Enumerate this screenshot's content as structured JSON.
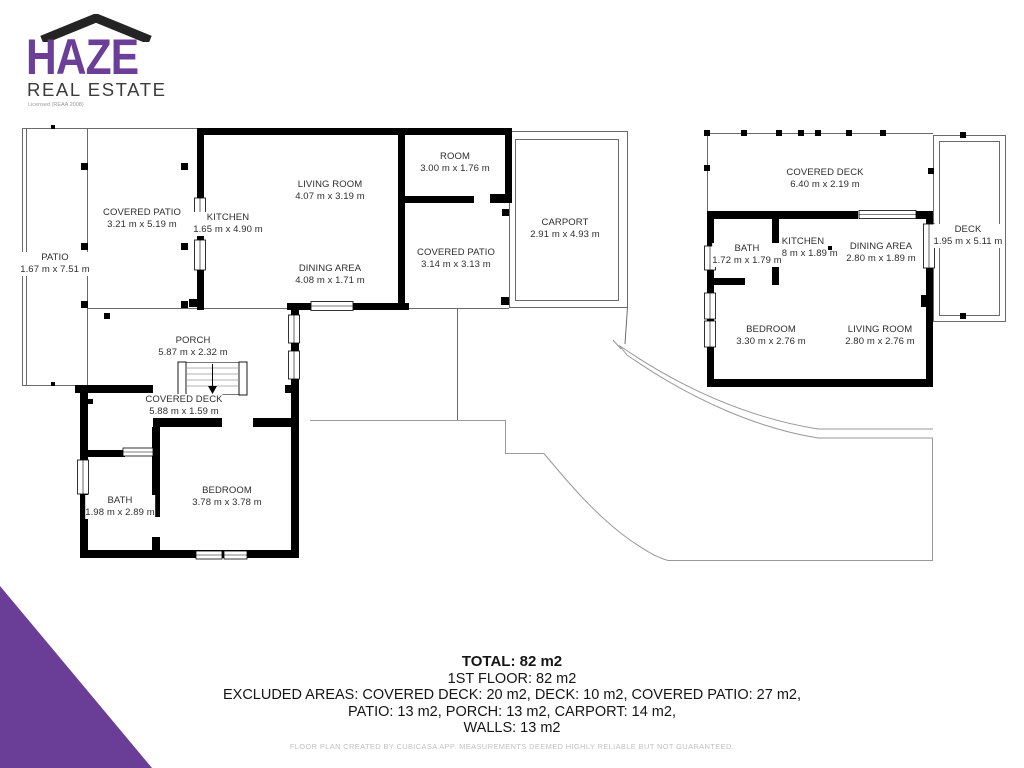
{
  "logo": {
    "name": "HAZE",
    "subtitle": "REAL ESTATE",
    "license": "Licensed (REAA 2008)",
    "brand_color": "#6b3e98",
    "roof_color": "#242424"
  },
  "plans": {
    "main": {
      "rooms": [
        {
          "name": "PATIO",
          "dims": "1.67 m x 7.51 m"
        },
        {
          "name": "COVERED PATIO",
          "dims": "3.21 m x 5.19 m"
        },
        {
          "name": "KITCHEN",
          "dims": "1.65 m x 4.90 m"
        },
        {
          "name": "LIVING ROOM",
          "dims": "4.07 m x 3.19 m"
        },
        {
          "name": "DINING AREA",
          "dims": "4.08 m x 1.71 m"
        },
        {
          "name": "ROOM",
          "dims": "3.00 m x 1.76 m"
        },
        {
          "name": "COVERED PATIO",
          "dims": "3.14 m x 3.13 m"
        },
        {
          "name": "CARPORT",
          "dims": "2.91 m x 4.93 m"
        },
        {
          "name": "PORCH",
          "dims": "5.87 m x 2.32 m"
        },
        {
          "name": "COVERED DECK",
          "dims": "5.88 m x 1.59 m"
        },
        {
          "name": "BATH",
          "dims": "1.98 m x 2.89 m"
        },
        {
          "name": "BEDROOM",
          "dims": "3.78 m x 3.78 m"
        }
      ]
    },
    "second": {
      "rooms": [
        {
          "name": "COVERED DECK",
          "dims": "6.40 m x 2.19 m"
        },
        {
          "name": "BATH",
          "dims": "1.72 m x 1.79 m"
        },
        {
          "name": "KITCHEN",
          "dims": "1.48 m x 1.89 m"
        },
        {
          "name": "DINING AREA",
          "dims": "2.80 m x 1.89 m"
        },
        {
          "name": "DECK",
          "dims": "1.95 m x 5.11 m"
        },
        {
          "name": "BEDROOM",
          "dims": "3.30 m x 2.76 m"
        },
        {
          "name": "LIVING ROOM",
          "dims": "2.80 m x 2.76 m"
        }
      ]
    }
  },
  "summary": {
    "total": "TOTAL: 82 m2",
    "first_floor": "1ST FLOOR: 82 m2",
    "excluded_line1": "EXCLUDED AREAS: COVERED DECK: 20 m2, DECK: 10 m2, COVERED PATIO: 27 m2,",
    "excluded_line2": "PATIO: 13 m2, PORCH: 13 m2, CARPORT: 14 m2,",
    "excluded_line3": "WALLS: 13 m2"
  },
  "footer": {
    "disclaimer": "FLOOR PLAN CREATED BY CUBICASA APP. MEASUREMENTS DEEMED HIGHLY RELIABLE BUT NOT GUARANTEED."
  },
  "colors": {
    "wall": "#000000",
    "thin_line": "#6a6a6a",
    "terrain_line": "#999999",
    "accent_purple": "#6a3d96"
  }
}
